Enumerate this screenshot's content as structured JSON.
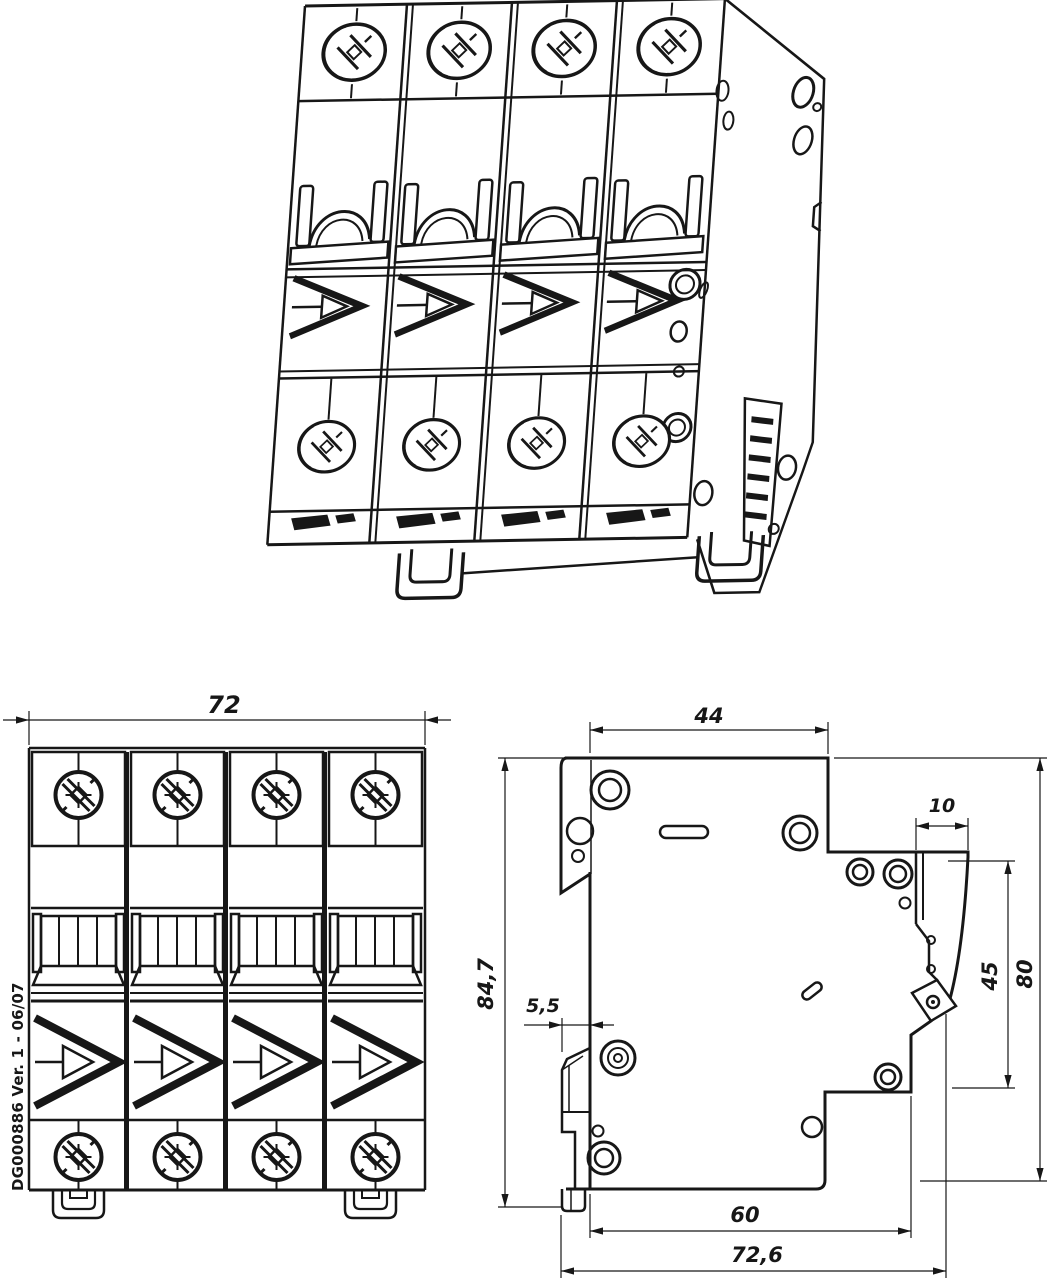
{
  "document": {
    "background": "#ffffff",
    "line_color": "#171717"
  },
  "views": {
    "isometric": {
      "subject": "4-pole miniature circuit breaker"
    },
    "front": {
      "width_dim": "72",
      "doc_ref": "DG000886 Ver. 1 - 06/07"
    },
    "side": {
      "top_depth": "44",
      "handle_step_depth": "10",
      "front_section_height": "45",
      "body_height": "80",
      "overall_height": "84,7",
      "rail_claw_depth": "5,5",
      "body_depth": "60",
      "overall_depth": "72,6"
    }
  }
}
